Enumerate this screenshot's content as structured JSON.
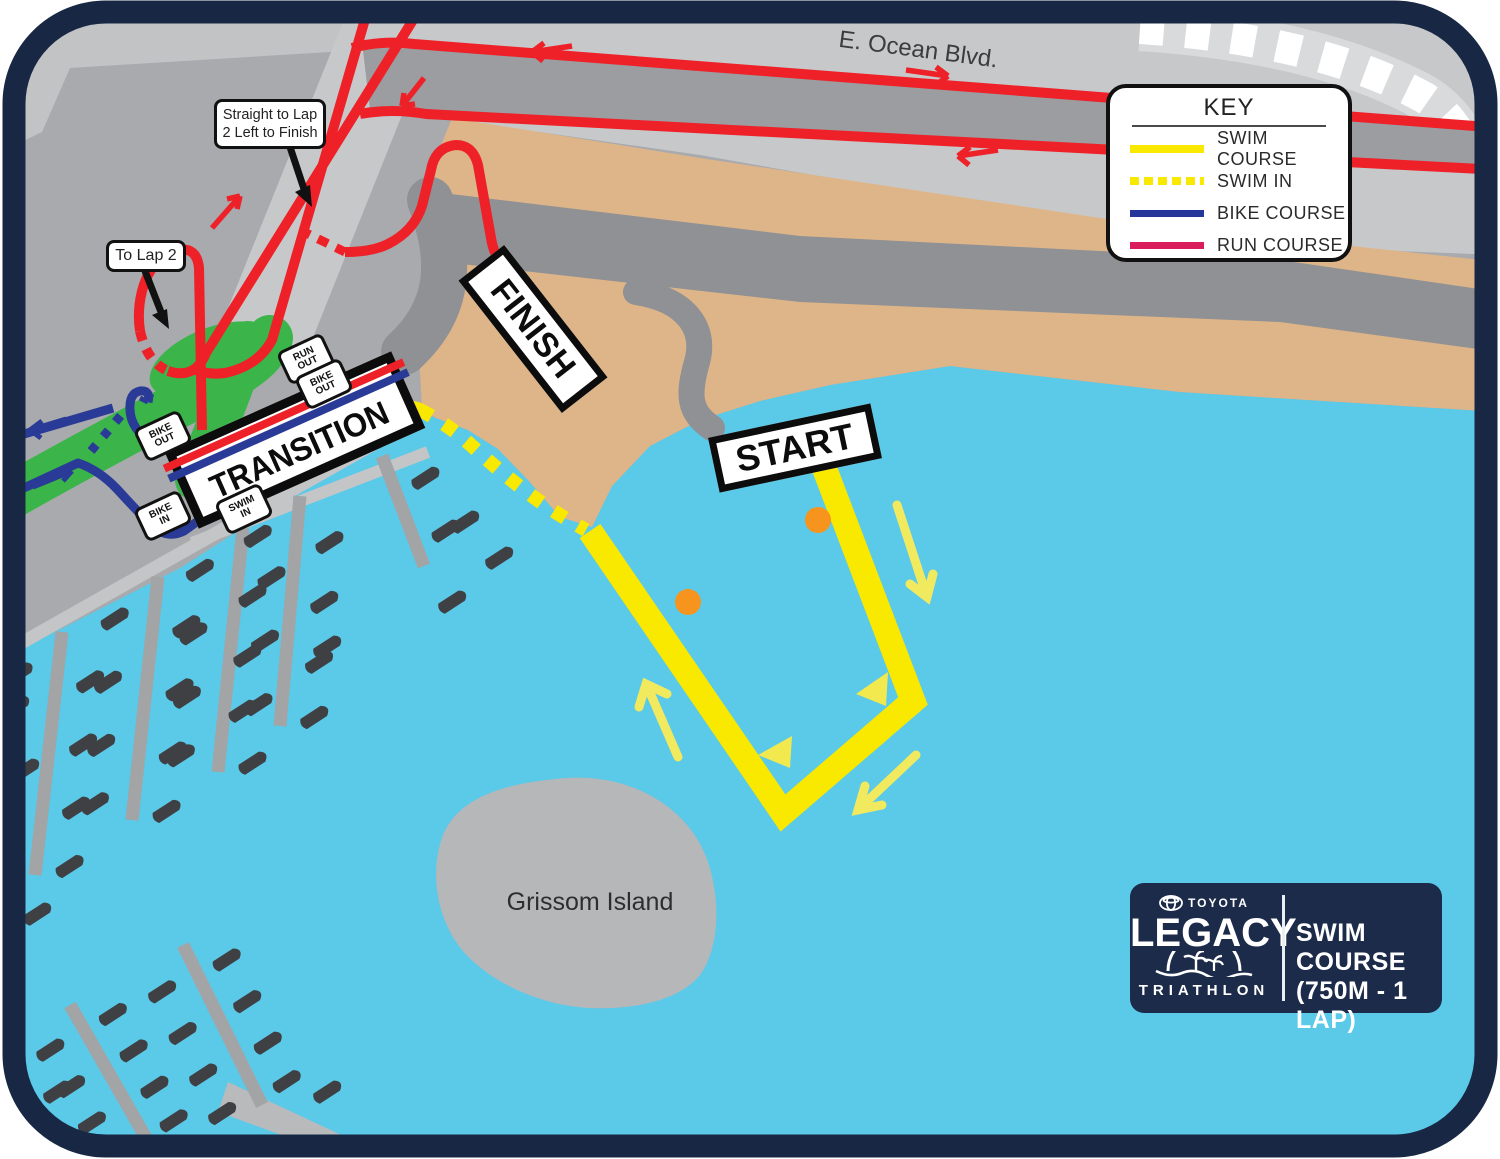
{
  "map": {
    "title": "Legacy Triathlon Swim Course Map",
    "road_label": "E. Ocean Blvd.",
    "island_label": "Grissom Island",
    "signs": {
      "start": "START",
      "finish": "FINISH",
      "transition": "TRANSITION"
    },
    "tags": {
      "run_out": {
        "line1": "RUN",
        "line2": "OUT"
      },
      "bike_out_top": {
        "line1": "BIKE",
        "line2": "OUT"
      },
      "bike_out_left": {
        "line1": "BIKE",
        "line2": "OUT"
      },
      "bike_in": {
        "line1": "BIKE",
        "line2": "IN"
      },
      "swim_in": {
        "line1": "SWIM",
        "line2": "IN"
      }
    },
    "callouts": {
      "lap2_finish": {
        "line1": "Straight to Lap",
        "line2": "2 Left to Finish"
      },
      "to_lap2": "To Lap 2"
    },
    "buoys": 2
  },
  "key": {
    "title": "KEY",
    "items": [
      {
        "id": "swim-course",
        "label": "SWIM COURSE",
        "color": "#f9e800",
        "style": "solid"
      },
      {
        "id": "swim-in",
        "label": "SWIM IN",
        "color": "#f9e800",
        "style": "dashed"
      },
      {
        "id": "bike-course",
        "label": "BIKE COURSE",
        "color": "#26379b",
        "style": "solid"
      },
      {
        "id": "run-course",
        "label": "RUN COURSE",
        "color": "#da1c5b",
        "style": "solid"
      }
    ]
  },
  "logo": {
    "brand_top": "TOYOTA",
    "brand_main": "LEGACY",
    "brand_bottom": "TRIATHLON",
    "course_line1": "SWIM COURSE",
    "course_line2": "(750M - 1 LAP)"
  },
  "colors": {
    "water": "#5bc9e8",
    "land": "#a8aaad",
    "land_light": "#c7c8ca",
    "road_dark": "#9b9da0",
    "boardwalk": "#8f9194",
    "beach": "#deb588",
    "green": "#3bb54a",
    "swim_yellow": "#f9e800",
    "pale_yellow": "#f2ea5e",
    "bike_blue": "#2a3b97",
    "run_red": "#ee2128",
    "legend_run": "#da1c5b",
    "buoy_orange": "#f7941e",
    "border_navy": "#182844",
    "logo_navy": "#1c2b4a"
  }
}
